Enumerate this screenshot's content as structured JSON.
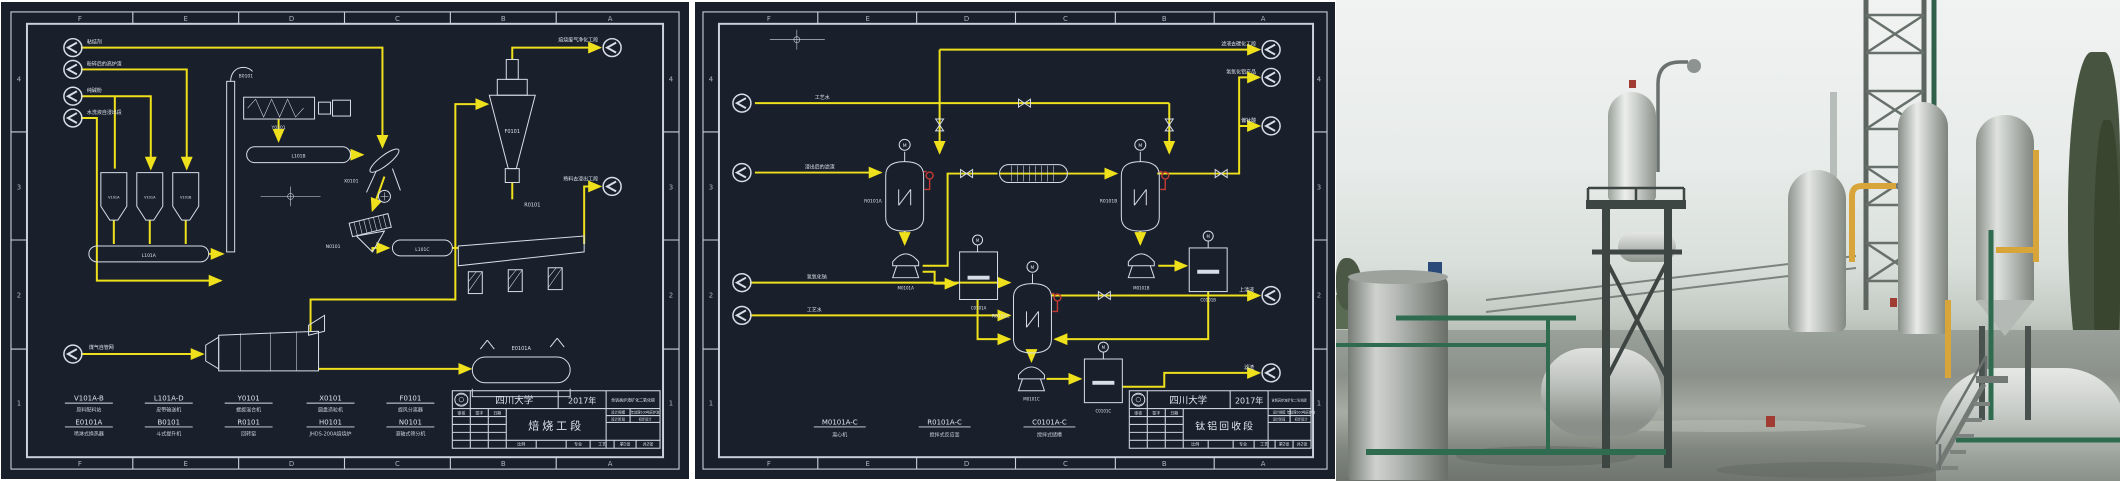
{
  "colors": {
    "sheet_bg": "#1a202b",
    "frame_line": "#c9d1db",
    "drawing_line": "#d7dee8",
    "flow_line": "#efe01c",
    "instrument_red": "#c23a33"
  },
  "zones": {
    "letters": [
      "F",
      "E",
      "D",
      "C",
      "B",
      "A"
    ],
    "numbers": [
      "4",
      "3",
      "2",
      "1"
    ]
  },
  "org": "四川大学",
  "year": "2017年",
  "project": "含钒高炉渣矿化二氧化碳",
  "sym": {
    "motor": "M"
  },
  "tb": {
    "headers": [
      "审核",
      "签字",
      "日期"
    ],
    "scale_label": "比例",
    "major_label": "专业",
    "major_value": "工艺",
    "total_label": "共2张",
    "info": [
      [
        "设计规模",
        "年处理100吨高炉渣"
      ],
      [
        "设计阶段",
        "初步设计"
      ]
    ]
  },
  "p1": {
    "title": "焙烧工段",
    "sheet": "第1张",
    "streams": {
      "in1": "粘结剂",
      "in2": "粉碎后的高炉渣",
      "in3": "纯碱粉",
      "in4": "水洗液自浸出段",
      "fuel": "煤气自管网",
      "out_top": "焙烧废气净化工段",
      "out_mid": "熟料去浸出工段"
    },
    "eq": {
      "bins": [
        "V101A",
        "V101A",
        "V101B"
      ],
      "conveyors": [
        "L101A",
        "L101B",
        "L101C"
      ],
      "mixer": "Y0101",
      "elevator": "B0101",
      "granulator": "X0101",
      "screen": "N0101",
      "cyclone": "F0101",
      "kiln": "R0101",
      "cooler": "E0101A"
    },
    "legend": [
      {
        "code": "V101A-B",
        "name": "原料配料站"
      },
      {
        "code": "L101A-D",
        "name": "皮带输送机"
      },
      {
        "code": "Y0101",
        "name": "螺旋混合机"
      },
      {
        "code": "X0101",
        "name": "圆盘造粒机"
      },
      {
        "code": "F0101",
        "name": "旋风分离器"
      },
      {
        "code": "E0101A",
        "name": "喷淋式换热器"
      },
      {
        "code": "B0101",
        "name": "斗式提升机"
      },
      {
        "code": "R0101",
        "name": "回转窑"
      },
      {
        "code": "H0101",
        "name": "JHDS-200A焙烧炉"
      },
      {
        "code": "N0101",
        "name": "滚轴式筛分机"
      }
    ]
  },
  "p2": {
    "title": "钛铝回收段",
    "sheet": "第2张",
    "streams": {
      "in1": "工艺水",
      "in2": "浸出后的滤渣",
      "in3": "氢氧化钠",
      "in4": "工艺水",
      "out1": "滤液去碳化工段",
      "out2": "氢氧化铝产品",
      "out3": "偏钛酸",
      "out4": "上清液",
      "out5": "滤渣"
    },
    "eq": {
      "reactors": [
        "R0101A",
        "R0101B",
        "R0101C"
      ],
      "pumps": [
        "M0101A",
        "M0101B",
        "M0101C"
      ],
      "tanks": [
        "C0101A",
        "C0101B",
        "C0101C"
      ]
    },
    "legend": [
      {
        "code": "M0101A-C",
        "name": "离心机"
      },
      {
        "code": "R0101A-C",
        "name": "搅拌式反应釜"
      },
      {
        "code": "C0101A-C",
        "name": "搅拌式储槽"
      }
    ]
  },
  "photo": {
    "colors": {
      "sky": "#e9ece9",
      "ground": "#8b908a",
      "vessel_steel": "#c6cac6",
      "structure_steel": "#3e4644",
      "pipe_green": "#2f6b4f",
      "pipe_yellow": "#d8a53a",
      "trees": "#47543f"
    }
  }
}
